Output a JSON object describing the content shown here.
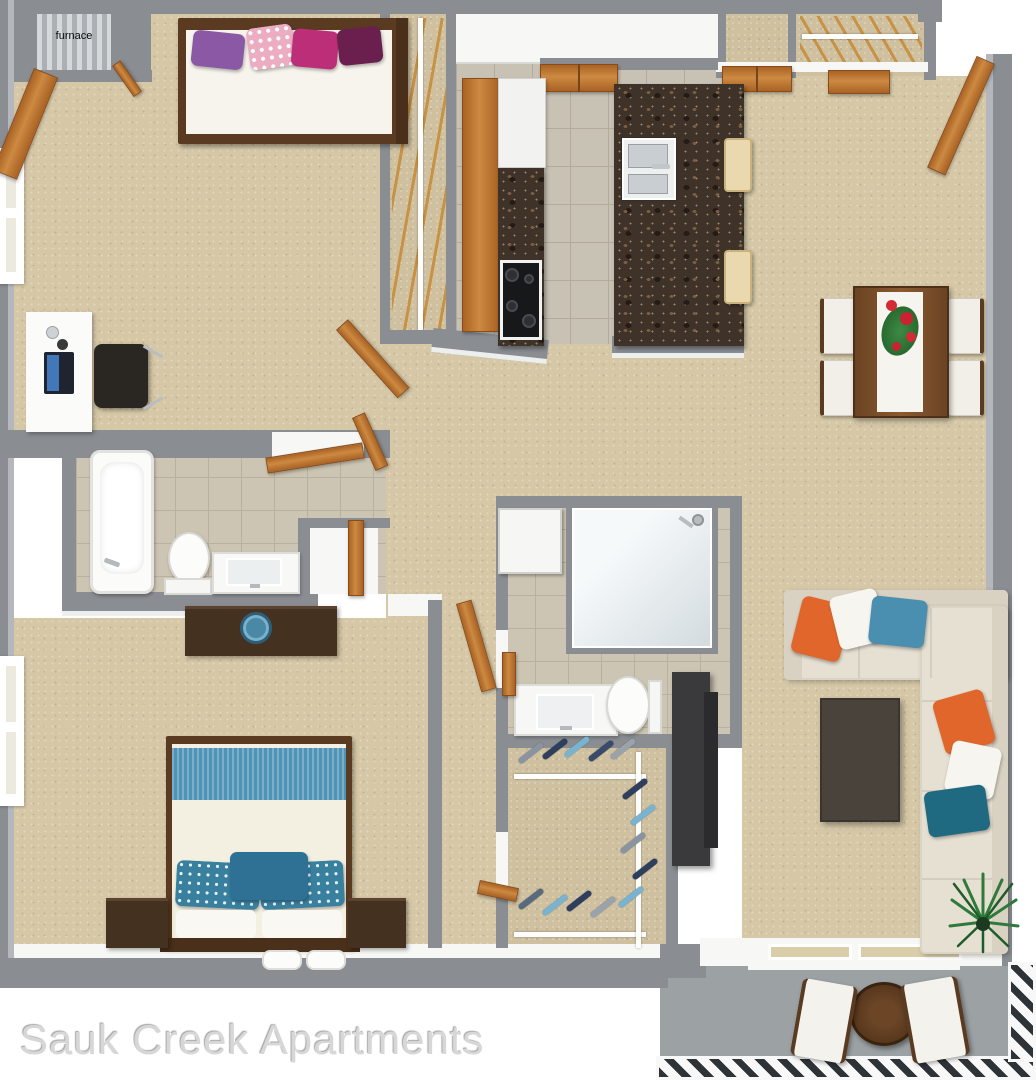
{
  "watermark": {
    "text": "Sauk Creek Apartments",
    "color": "#d7d7d7"
  },
  "labels": {
    "furnace": "furnace"
  },
  "palette": {
    "wall": "#8a8e93",
    "carpet": "#d6c8a7",
    "kitchen_tile": "#c8c2b5",
    "bath_tile": "#cdc5b3",
    "granite_counter": "#3f3329",
    "wood_door": "#c07a36",
    "dark_wood_furniture": "#5a3b22",
    "white_fixture": "#f7f7f5",
    "patio_concrete": "#9ca1a4",
    "accent_blue": "#4f93b6",
    "accent_teal": "#1f6a80",
    "accent_orange": "#e0662b",
    "accent_magenta": "#bc2f78",
    "accent_purple": "#8a58a4",
    "plant_green": "#2f7a3a"
  },
  "rooms": [
    "bedroom-1",
    "bedroom-1-closet",
    "furnace-closet",
    "kitchen",
    "laundry-closet",
    "entry-closet",
    "dining-area",
    "hallway",
    "bathroom-1",
    "linen-closet",
    "bedroom-2",
    "bathroom-2",
    "walk-in-closet",
    "living-room",
    "patio"
  ]
}
